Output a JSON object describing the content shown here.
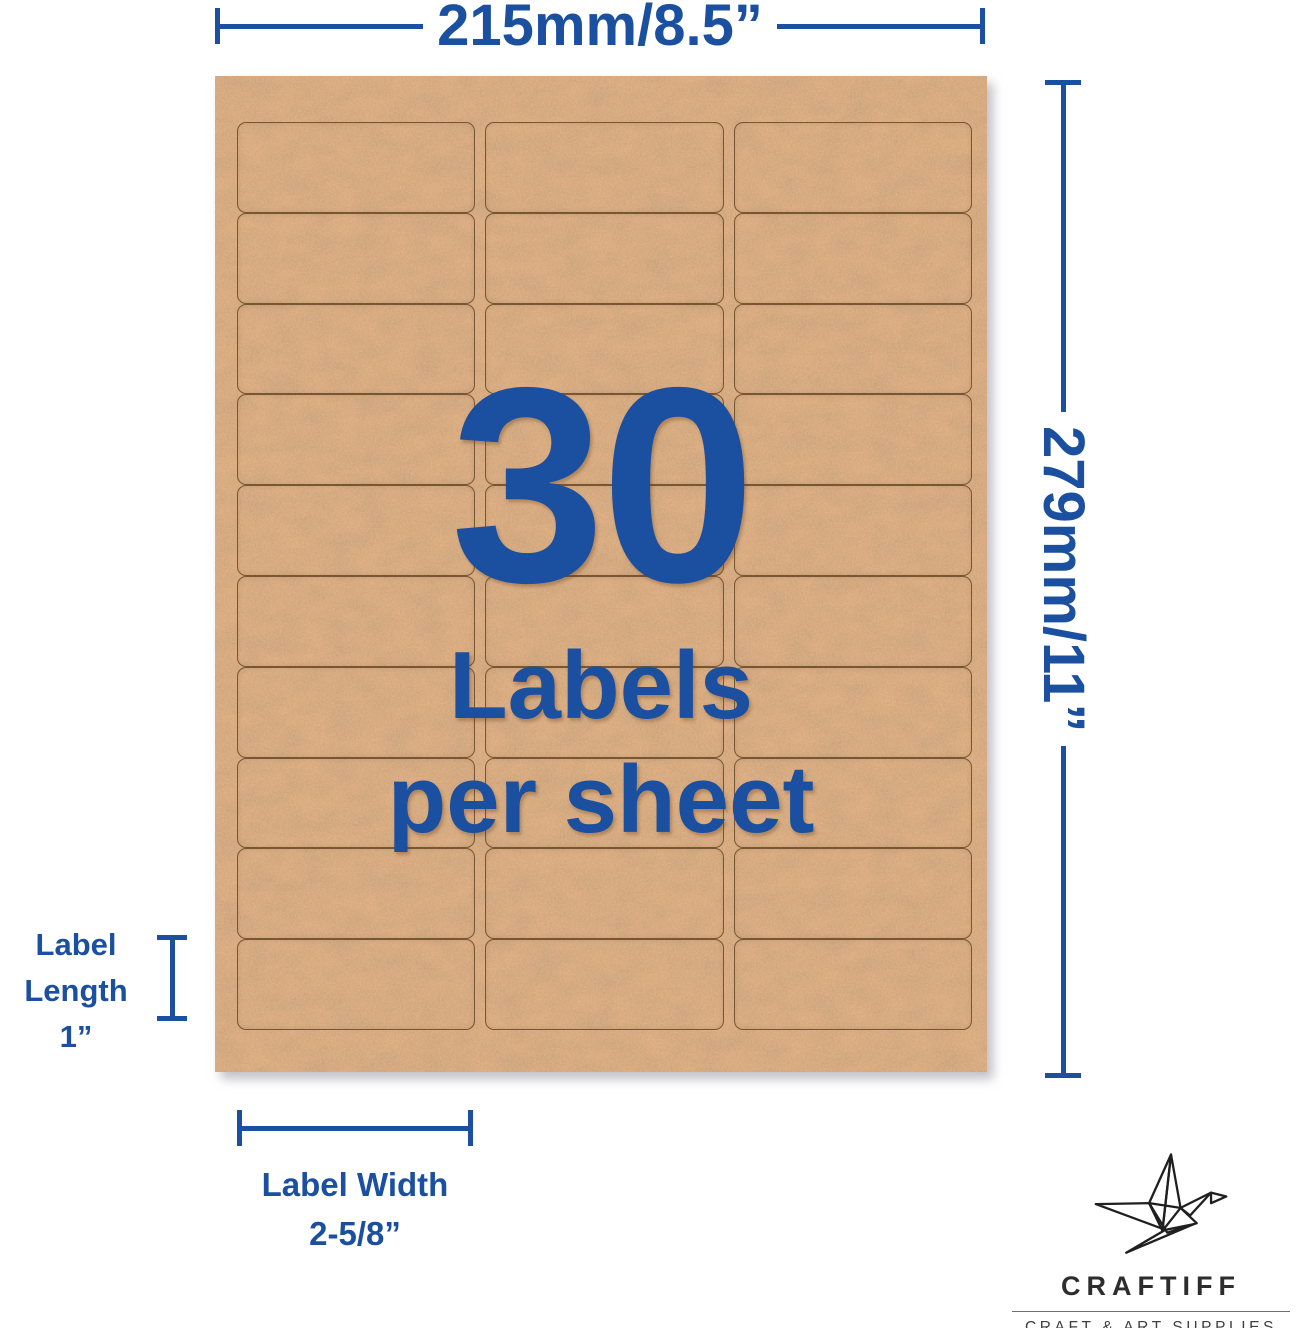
{
  "colors": {
    "accent_blue": "#1b4f9f",
    "kraft_base": "#d9a87c",
    "label_border": "#6f4f2e",
    "logo_dark": "#2d2d2d",
    "logo_gray": "#3f3f3f"
  },
  "top_dimension": {
    "label": "215mm/8.5”"
  },
  "right_dimension": {
    "label": "279mm/11”"
  },
  "length_annotation": {
    "line1": "Label",
    "line2": "Length",
    "line3": "1”"
  },
  "width_annotation": {
    "line1": "Label Width",
    "line2": "2-5/8”"
  },
  "sheet": {
    "overlay_number": "30",
    "overlay_caption_line1": "Labels",
    "overlay_caption_line2": "per sheet",
    "rows": 10,
    "columns": 3,
    "total_labels": 30
  },
  "logo": {
    "brand": "CRAFTIFF",
    "tagline": "CRAFT & ART SUPPLIES",
    "icon": "origami-crane-icon"
  }
}
